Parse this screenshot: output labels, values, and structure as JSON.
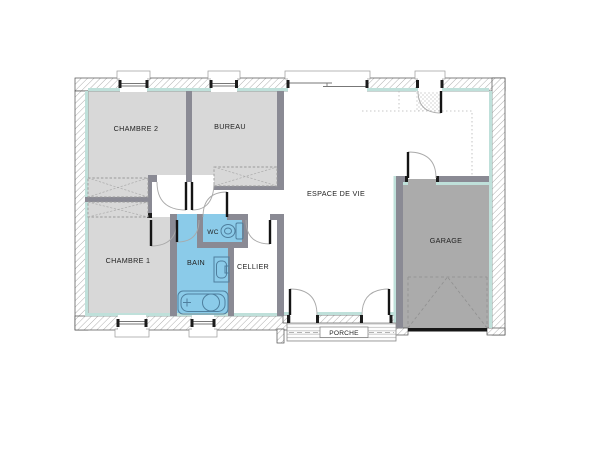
{
  "rooms": [
    {
      "id": "chambre2",
      "label": "CHAMBRE 2"
    },
    {
      "id": "bureau",
      "label": "BUREAU"
    },
    {
      "id": "espace_de_vie",
      "label": "ESPACE DE VIE"
    },
    {
      "id": "garage",
      "label": "GARAGE"
    },
    {
      "id": "chambre1",
      "label": "CHAMBRE 1"
    },
    {
      "id": "bain",
      "label": "BAIN"
    },
    {
      "id": "wc",
      "label": "WC"
    },
    {
      "id": "cellier",
      "label": "CELLIER"
    },
    {
      "id": "porche",
      "label": "PORCHE"
    }
  ],
  "colors": {
    "room_fill": "#d8d8d8",
    "garage_fill": "#ababab",
    "wet_fill": "#8bcbe9",
    "insulation": "#bfe0da",
    "wall": "#8a8a94",
    "label": "#222222",
    "fixture_fill": "#dff0f9"
  }
}
